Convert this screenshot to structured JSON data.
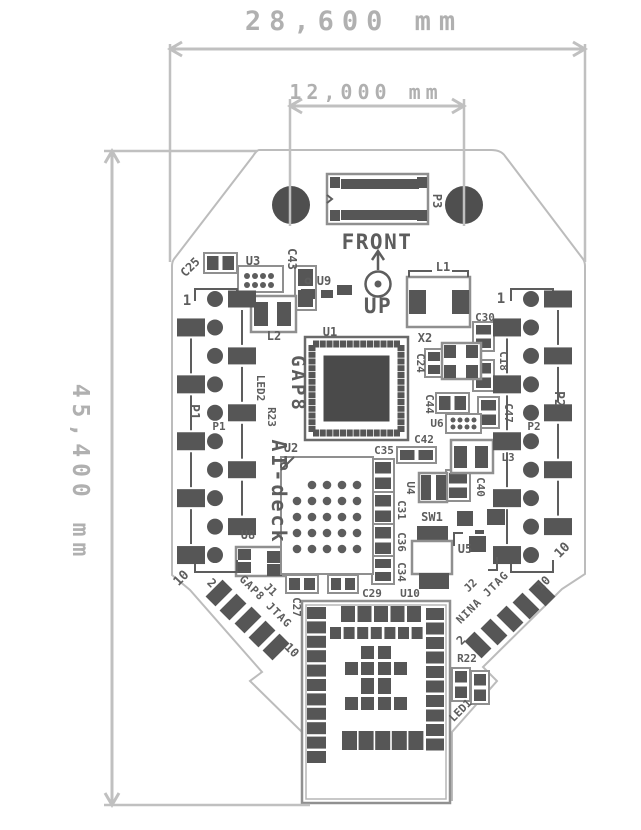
{
  "title": "AI-deck PCB dimension drawing",
  "dimensions": {
    "board_width": "28,600 mm",
    "hole_spacing": "12,000 mm",
    "board_height": "45,400 mm"
  },
  "colors": {
    "silk": "#5d5d5d",
    "pad": "#565656",
    "hole": "#4f4f4f",
    "comp_outline": "#8f8f8f",
    "board_edge": "#bcbcbc",
    "dim": "#c0c0c0",
    "module_border": "#909090",
    "module_inner": "#b5b5b5"
  },
  "pcb": {
    "labels": [
      {
        "id": "u3",
        "t": "U3",
        "x": 253,
        "y": 265,
        "r": 0,
        "s": 12
      },
      {
        "id": "c43",
        "t": "C43",
        "x": 288,
        "y": 259,
        "r": 90,
        "s": 12
      },
      {
        "id": "c25",
        "t": "C25",
        "x": 193,
        "y": 270,
        "r": -45,
        "s": 12
      },
      {
        "id": "u9",
        "t": "U9",
        "x": 324,
        "y": 285,
        "r": 0,
        "s": 12
      },
      {
        "id": "p1-pin1",
        "t": "1",
        "x": 187,
        "y": 305,
        "r": 0,
        "s": 14
      },
      {
        "id": "p1-big",
        "t": "P1",
        "x": 190,
        "y": 412,
        "r": 90,
        "s": 13
      },
      {
        "id": "p1-small",
        "t": "P1",
        "x": 219,
        "y": 430,
        "r": 0,
        "s": 11
      },
      {
        "id": "led2",
        "t": "LED2",
        "x": 257,
        "y": 388,
        "r": 90,
        "s": 11
      },
      {
        "id": "r23",
        "t": "R23",
        "x": 268,
        "y": 417,
        "r": 90,
        "s": 11
      },
      {
        "id": "l2",
        "t": "L2",
        "x": 274,
        "y": 340,
        "r": 0,
        "s": 12
      },
      {
        "id": "u1",
        "t": "U1",
        "x": 330,
        "y": 336,
        "r": 0,
        "s": 12
      },
      {
        "id": "gap8",
        "t": "GAP8",
        "x": 292,
        "y": 384,
        "r": 90,
        "s": 19,
        "ls": 3
      },
      {
        "id": "ai-deck",
        "t": "AI-deck",
        "x": 272,
        "y": 492,
        "r": 90,
        "s": 20,
        "ls": 3
      },
      {
        "id": "u2",
        "t": "U2",
        "x": 291,
        "y": 452,
        "r": 0,
        "s": 12
      },
      {
        "id": "front",
        "t": "FRONT",
        "x": 377,
        "y": 249,
        "r": 0,
        "s": 21,
        "ls": 1.5
      },
      {
        "id": "up",
        "t": "UP",
        "x": 378,
        "y": 313,
        "r": 0,
        "s": 21,
        "ls": 1.5
      },
      {
        "id": "p3",
        "t": "P3",
        "x": 433,
        "y": 201,
        "r": 90,
        "s": 12
      },
      {
        "id": "l1",
        "t": "L1",
        "x": 443,
        "y": 271,
        "r": 0,
        "s": 12
      },
      {
        "id": "x2",
        "t": "X2",
        "x": 425,
        "y": 342,
        "r": 0,
        "s": 12
      },
      {
        "id": "c24",
        "t": "C24",
        "x": 417,
        "y": 363,
        "r": 90,
        "s": 11
      },
      {
        "id": "c30",
        "t": "C30",
        "x": 485,
        "y": 321,
        "r": 0,
        "s": 11
      },
      {
        "id": "c18",
        "t": "C18",
        "x": 500,
        "y": 361,
        "r": 90,
        "s": 11
      },
      {
        "id": "p2-pin1",
        "t": "1",
        "x": 501,
        "y": 303,
        "r": 0,
        "s": 14
      },
      {
        "id": "p2-big",
        "t": "P2",
        "x": 555,
        "y": 399,
        "r": 90,
        "s": 13
      },
      {
        "id": "p2-small",
        "t": "P2",
        "x": 534,
        "y": 430,
        "r": 0,
        "s": 11
      },
      {
        "id": "p2-pin10",
        "t": "10",
        "x": 565,
        "y": 553,
        "r": -45,
        "s": 13
      },
      {
        "id": "c44",
        "t": "C44",
        "x": 426,
        "y": 404,
        "r": 90,
        "s": 11
      },
      {
        "id": "u6",
        "t": "U6",
        "x": 437,
        "y": 427,
        "r": 0,
        "s": 11
      },
      {
        "id": "c47",
        "t": "C47",
        "x": 505,
        "y": 413,
        "r": 90,
        "s": 11
      },
      {
        "id": "c42",
        "t": "C42",
        "x": 424,
        "y": 443,
        "r": 0,
        "s": 11
      },
      {
        "id": "l3",
        "t": "L3",
        "x": 508,
        "y": 461,
        "r": 0,
        "s": 11
      },
      {
        "id": "c40",
        "t": "C40",
        "x": 477,
        "y": 487,
        "r": 90,
        "s": 11
      },
      {
        "id": "u4",
        "t": "U4",
        "x": 407,
        "y": 488,
        "r": 90,
        "s": 11
      },
      {
        "id": "c35",
        "t": "C35",
        "x": 384,
        "y": 454,
        "r": 0,
        "s": 11
      },
      {
        "id": "c31",
        "t": "C31",
        "x": 398,
        "y": 510,
        "r": 90,
        "s": 11
      },
      {
        "id": "c36",
        "t": "C36",
        "x": 398,
        "y": 542,
        "r": 90,
        "s": 11
      },
      {
        "id": "c34",
        "t": "C34",
        "x": 398,
        "y": 572,
        "r": 90,
        "s": 11
      },
      {
        "id": "sw1",
        "t": "SW1",
        "x": 432,
        "y": 521,
        "r": 0,
        "s": 12
      },
      {
        "id": "u5",
        "t": "U5",
        "x": 465,
        "y": 553,
        "r": 0,
        "s": 12
      },
      {
        "id": "u8",
        "t": "U8",
        "x": 248,
        "y": 539,
        "r": 0,
        "s": 12
      },
      {
        "id": "p1-pin10",
        "t": "10",
        "x": 184,
        "y": 581,
        "r": -45,
        "s": 13
      },
      {
        "id": "j1-pin2",
        "t": "2",
        "x": 209,
        "y": 586,
        "r": 45,
        "s": 12
      },
      {
        "id": "j1",
        "t": "J1",
        "x": 268,
        "y": 592,
        "r": 45,
        "s": 11
      },
      {
        "id": "j1-name",
        "t": "GAP8 JTAG",
        "x": 263,
        "y": 604,
        "r": 45,
        "s": 11,
        "ls": 1
      },
      {
        "id": "j1-pin10",
        "t": "10",
        "x": 289,
        "y": 653,
        "r": 45,
        "s": 12
      },
      {
        "id": "c27",
        "t": "C27",
        "x": 293,
        "y": 607,
        "r": 90,
        "s": 11
      },
      {
        "id": "c29",
        "t": "C29",
        "x": 372,
        "y": 597,
        "r": 0,
        "s": 11
      },
      {
        "id": "u10",
        "t": "U10",
        "x": 410,
        "y": 597,
        "r": 0,
        "s": 11
      },
      {
        "id": "j2",
        "t": "J2",
        "x": 473,
        "y": 588,
        "r": -45,
        "s": 11
      },
      {
        "id": "j2-name",
        "t": "NINA JTAG",
        "x": 485,
        "y": 600,
        "r": -45,
        "s": 11,
        "ls": 1
      },
      {
        "id": "j2-pin10",
        "t": "10",
        "x": 546,
        "y": 586,
        "r": -45,
        "s": 12
      },
      {
        "id": "j2-pin2",
        "t": "2",
        "x": 464,
        "y": 643,
        "r": -45,
        "s": 12
      },
      {
        "id": "r22",
        "t": "R22",
        "x": 467,
        "y": 662,
        "r": 0,
        "s": 11
      },
      {
        "id": "led1",
        "t": "LED1",
        "x": 463,
        "y": 713,
        "r": -45,
        "s": 11
      }
    ],
    "caps": [
      {
        "id": "c43",
        "x": 295,
        "y": 266,
        "w": 21,
        "h": 44,
        "o": "v"
      },
      {
        "id": "c24",
        "x": 425,
        "y": 349,
        "w": 18,
        "h": 28,
        "o": "v"
      },
      {
        "id": "c30",
        "x": 473,
        "y": 322,
        "w": 21,
        "h": 29,
        "o": "v"
      },
      {
        "id": "c18",
        "x": 473,
        "y": 360,
        "w": 21,
        "h": 31,
        "o": "v"
      },
      {
        "id": "c47",
        "x": 478,
        "y": 397,
        "w": 21,
        "h": 31,
        "o": "v"
      },
      {
        "id": "c40",
        "x": 446,
        "y": 470,
        "w": 24,
        "h": 31,
        "o": "v"
      },
      {
        "id": "c35",
        "x": 372,
        "y": 459,
        "w": 22,
        "h": 33,
        "o": "v"
      },
      {
        "id": "c31",
        "x": 372,
        "y": 492,
        "w": 22,
        "h": 33,
        "o": "v"
      },
      {
        "id": "c36",
        "x": 372,
        "y": 524,
        "w": 22,
        "h": 33,
        "o": "v"
      },
      {
        "id": "c34",
        "x": 372,
        "y": 556,
        "w": 22,
        "h": 28,
        "o": "v"
      },
      {
        "id": "r22",
        "x": 452,
        "y": 668,
        "w": 18,
        "h": 33,
        "o": "v"
      },
      {
        "id": "led1",
        "x": 471,
        "y": 671,
        "w": 18,
        "h": 33,
        "o": "v"
      },
      {
        "id": "c25",
        "x": 204,
        "y": 253,
        "w": 33,
        "h": 20,
        "o": "h"
      },
      {
        "id": "c44",
        "x": 436,
        "y": 393,
        "w": 33,
        "h": 20,
        "o": "h"
      },
      {
        "id": "c42",
        "x": 397,
        "y": 447,
        "w": 39,
        "h": 16,
        "o": "h"
      },
      {
        "id": "c27",
        "x": 286,
        "y": 575,
        "w": 32,
        "h": 18,
        "o": "h"
      },
      {
        "id": "c29",
        "x": 328,
        "y": 575,
        "w": 30,
        "h": 18,
        "o": "h"
      }
    ],
    "pads": [
      [
        301,
        289,
        14,
        10
      ],
      [
        321,
        290,
        12,
        8
      ],
      [
        337,
        285,
        15,
        10
      ],
      [
        457,
        511,
        16,
        15
      ],
      [
        487,
        509,
        18,
        16
      ],
      [
        502,
        547,
        18,
        17
      ],
      [
        475,
        530,
        9,
        4
      ],
      [
        469,
        536,
        17,
        16
      ]
    ],
    "ics": [
      {
        "id": "u3",
        "box": [
          238,
          266,
          45,
          26
        ],
        "cols": [
          247,
          255,
          263,
          271
        ],
        "rows": [
          276,
          285
        ],
        "r": 3
      },
      {
        "id": "u6",
        "box": [
          446,
          414,
          35,
          19
        ],
        "cols": [
          453,
          460,
          467,
          474
        ],
        "rows": [
          420,
          427
        ],
        "r": 2.5
      }
    ],
    "boxes": [
      {
        "id": "l1",
        "box": [
          407,
          277,
          63,
          50
        ],
        "pads": [
          [
            409,
            290,
            17,
            24
          ],
          [
            452,
            290,
            17,
            24
          ]
        ]
      },
      {
        "id": "l2",
        "box": [
          251,
          296,
          45,
          36
        ],
        "pads": [
          [
            254,
            302,
            14,
            24
          ],
          [
            277,
            302,
            14,
            24
          ]
        ]
      },
      {
        "id": "l3",
        "box": [
          451,
          440,
          42,
          33
        ],
        "pads": [
          [
            454,
            446,
            13,
            22
          ],
          [
            475,
            446,
            13,
            22
          ]
        ]
      },
      {
        "id": "x2",
        "box": [
          442,
          343,
          39,
          36
        ],
        "pads": [
          [
            444,
            345,
            12,
            13
          ],
          [
            466,
            345,
            12,
            13
          ],
          [
            444,
            365,
            12,
            13
          ],
          [
            466,
            365,
            12,
            13
          ]
        ]
      },
      {
        "id": "u4",
        "box": [
          419,
          473,
          28,
          29
        ],
        "pads": [
          [
            421,
            475,
            10,
            25
          ],
          [
            436,
            475,
            10,
            25
          ]
        ]
      },
      {
        "id": "u8",
        "box": [
          236,
          547,
          48,
          29
        ],
        "pads": [
          [
            238,
            549,
            13,
            11
          ],
          [
            238,
            562,
            13,
            11
          ],
          [
            267,
            551,
            15,
            12
          ],
          [
            267,
            564,
            15,
            12
          ]
        ]
      }
    ],
    "gap8": {
      "box": [
        305,
        337,
        103,
        103
      ],
      "inner": [
        323.5,
        355.5,
        66,
        66
      ],
      "n": 13,
      "size": 6,
      "margin": 8
    },
    "u2": {
      "box": [
        281,
        457,
        92,
        117
      ],
      "cols": [
        297,
        312,
        327,
        342,
        357
      ],
      "rows": [
        485,
        501,
        517,
        533,
        549
      ],
      "r": 4.3
    },
    "sw1": {
      "top": [
        417,
        526,
        31,
        16
      ],
      "body": [
        412,
        541,
        40,
        33
      ],
      "bot": [
        419,
        573,
        30,
        16
      ]
    },
    "p3": {
      "box": [
        327,
        174,
        101,
        50
      ],
      "bars": [
        [
          341,
          179,
          78,
          10
        ],
        [
          341,
          210,
          78,
          10
        ]
      ],
      "corners": [
        [
          330,
          177,
          10,
          11
        ],
        [
          417,
          177,
          10,
          11
        ],
        [
          330,
          210,
          10,
          11
        ],
        [
          417,
          210,
          10,
          11
        ]
      ]
    },
    "holes": [
      [
        291,
        205,
        19
      ],
      [
        464,
        205,
        19
      ]
    ],
    "headers": [
      {
        "id": "p1",
        "cx": 215,
        "y0": 299,
        "step": 28.45,
        "n": 10,
        "r": 8
      },
      {
        "id": "p2",
        "cx": 531,
        "y0": 299,
        "step": 28.45,
        "n": 10,
        "r": 8
      }
    ],
    "jtag": [
      {
        "id": "j1",
        "rot": 45,
        "pts": [
          [
            219,
            593
          ],
          [
            233,
            607
          ],
          [
            248,
            620
          ],
          [
            262,
            634
          ],
          [
            276,
            647
          ]
        ]
      },
      {
        "id": "j2",
        "rot": -45,
        "pts": [
          [
            478,
            645
          ],
          [
            494,
            632
          ],
          [
            510,
            619
          ],
          [
            526,
            606
          ],
          [
            542,
            593
          ]
        ]
      }
    ],
    "module": {
      "outer": [
        302,
        601,
        148,
        202
      ],
      "inner": [
        306,
        605,
        140,
        194
      ],
      "left": {
        "x": 307,
        "w": 19,
        "y0": 607,
        "step": 14.4,
        "n": 11,
        "h": 12
      },
      "right": {
        "x": 426,
        "w": 18,
        "y0": 608,
        "step": 14.5,
        "n": 10,
        "h": 12
      },
      "top": {
        "y": 606,
        "h": 16,
        "x0": 341,
        "step": 16.5,
        "n": 5,
        "w": 14
      },
      "row2": {
        "y": 627,
        "h": 12,
        "x0": 330,
        "step": 13.6,
        "n": 7,
        "w": 11
      },
      "cluster": [
        {
          "y": 646,
          "h": 13,
          "xs": [
            361,
            378
          ]
        },
        {
          "y": 662,
          "h": 13,
          "xs": [
            345,
            361,
            378,
            394
          ]
        },
        {
          "y": 678,
          "h": 16,
          "xs": [
            361,
            378
          ]
        },
        {
          "y": 697,
          "h": 13,
          "xs": [
            345,
            361,
            378,
            394
          ]
        }
      ],
      "clusterW": 13,
      "bottom": {
        "y": 731,
        "h": 19,
        "x0": 342,
        "step": 16.6,
        "n": 5,
        "w": 15
      }
    },
    "rings": [
      [
        284,
        466,
        3
      ],
      [
        308,
        281,
        2.5
      ]
    ],
    "paths": [
      "M409,277 V271 H432 M468,277 V271 H452",
      "M281,470 L294,457",
      "M454,546 V533 H463 M497,557 V570 H488",
      "M327,195 L332,199 L327,203"
    ]
  }
}
